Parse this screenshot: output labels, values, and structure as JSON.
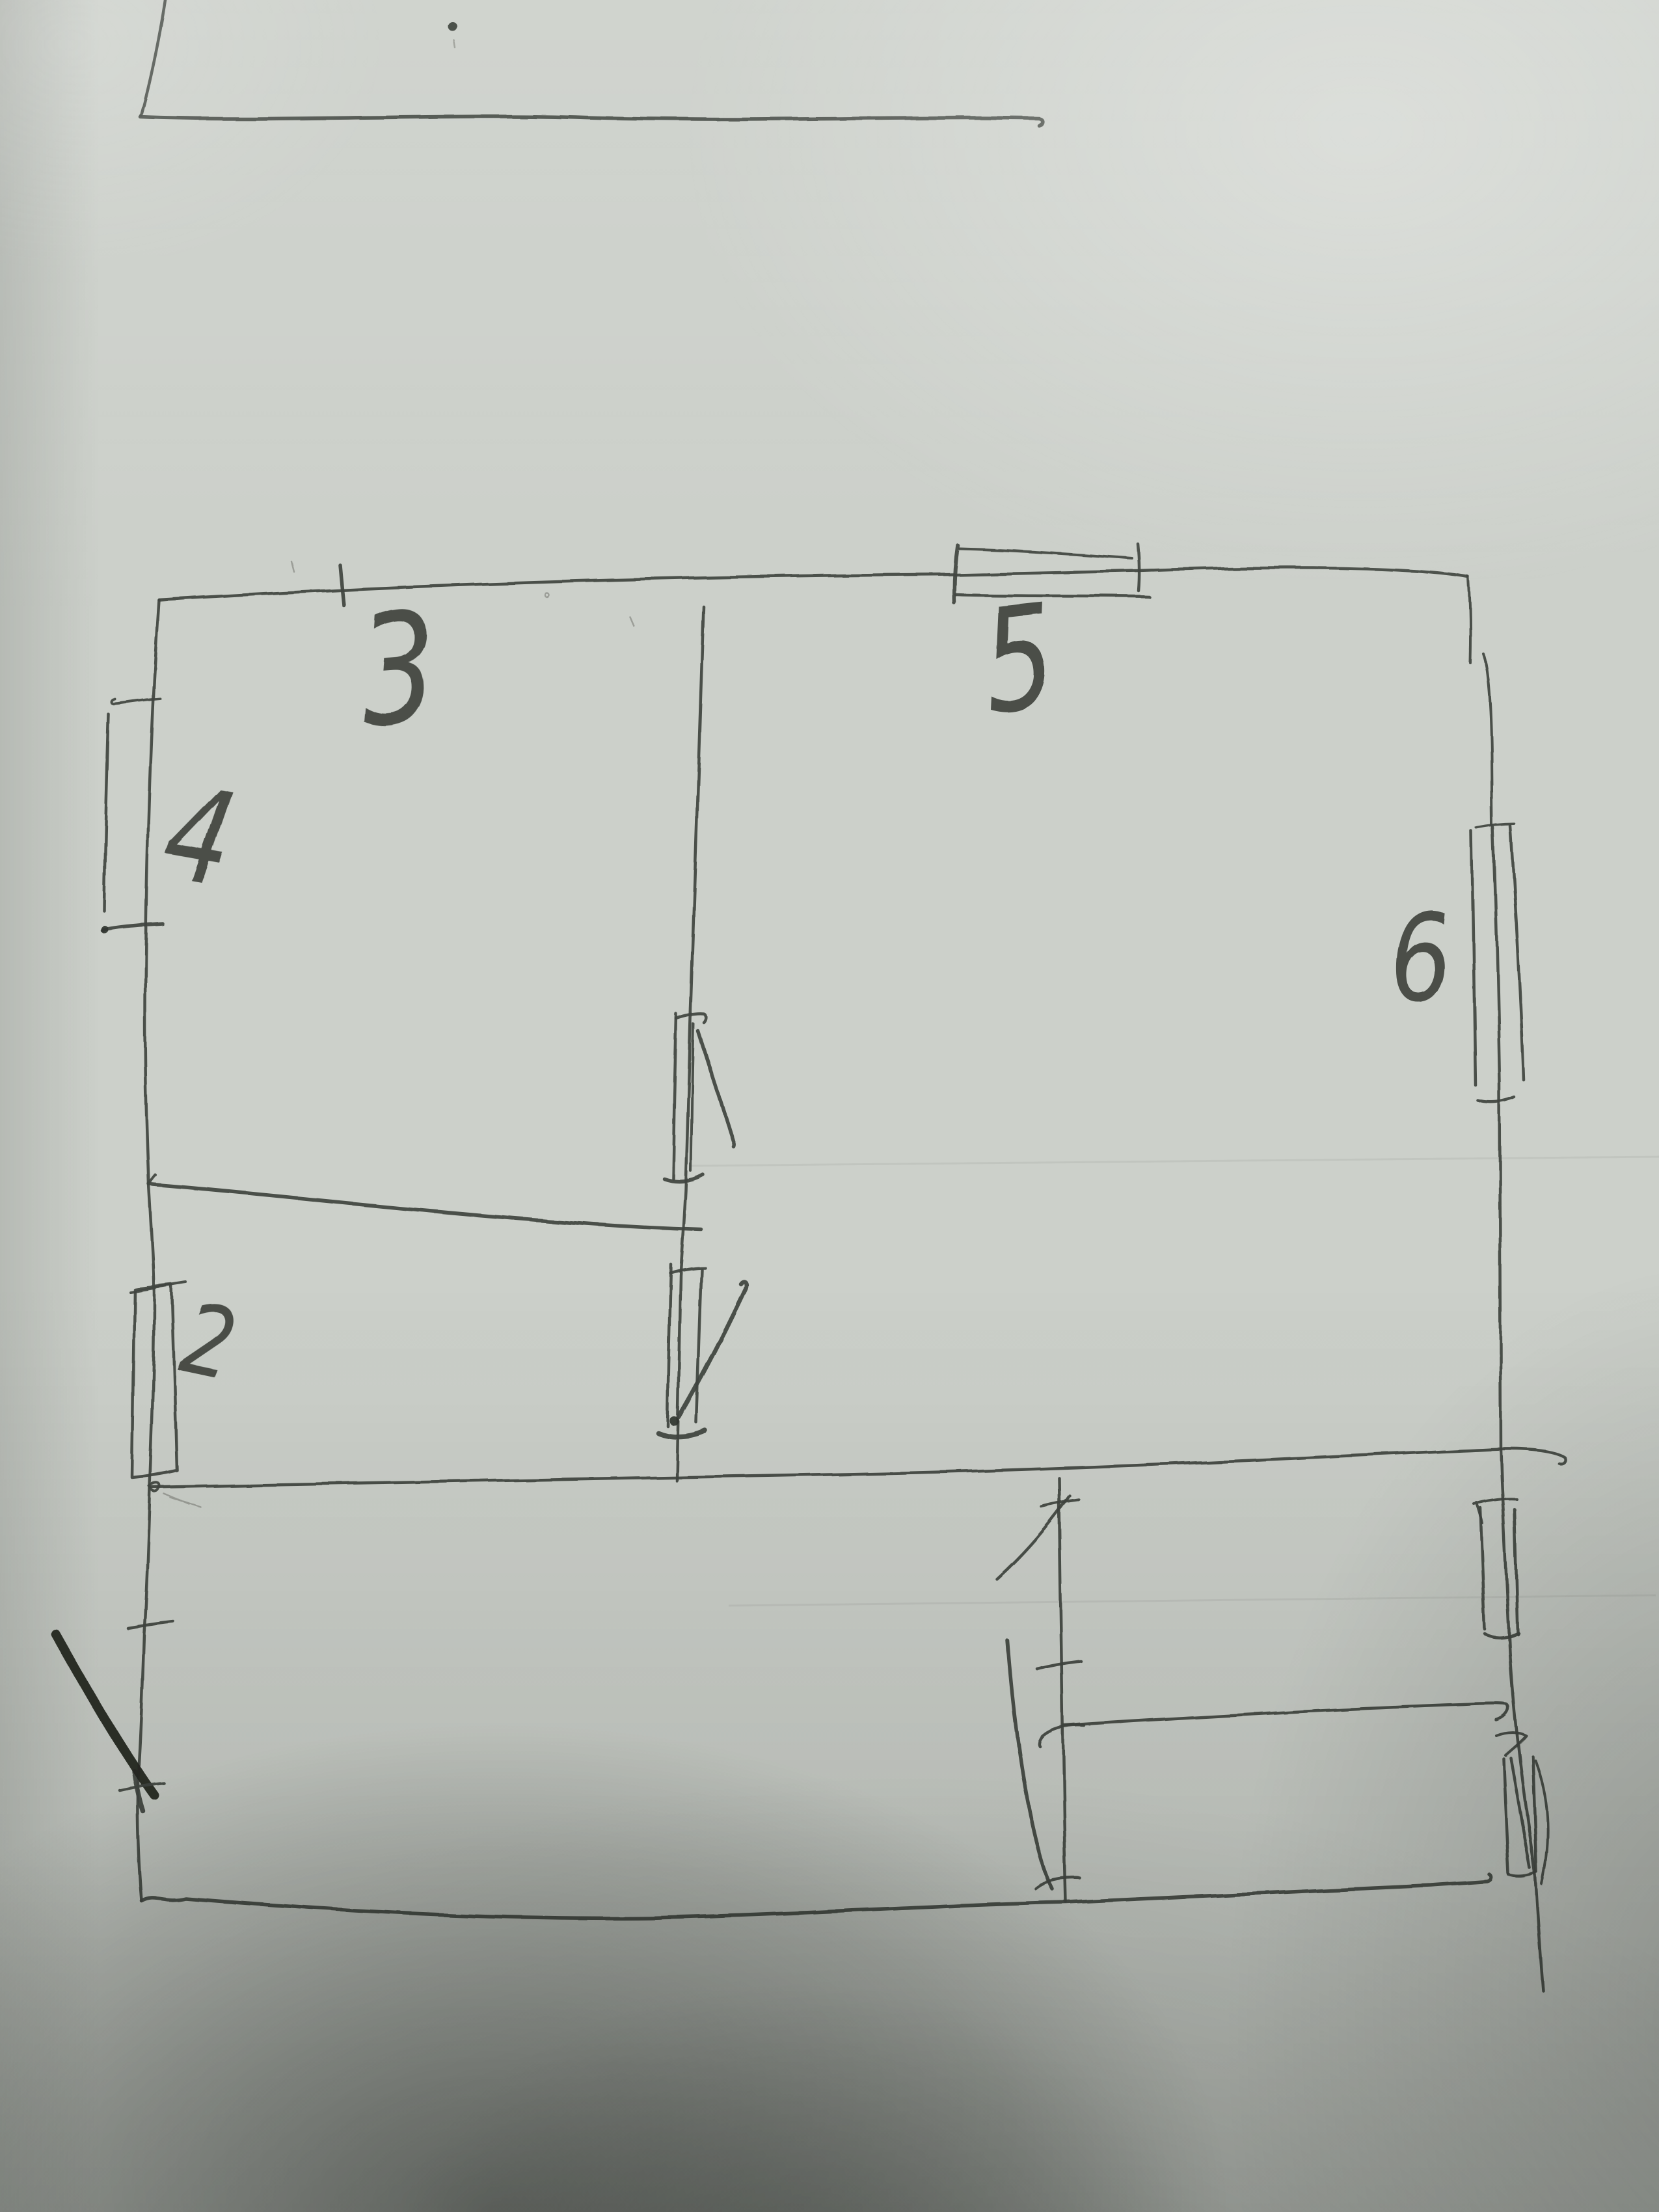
{
  "colors": {
    "paper": "#ccd0ca",
    "paper_bright": "#d6d9d3",
    "ink": "#41463f",
    "ink_bold": "#23261f",
    "shadow": "#878c84"
  },
  "sketch": {
    "kind": "hand-drawn floor plan on paper",
    "labels": [
      {
        "id": "label-3",
        "text": "3",
        "transform": "translate(560,1115) rotate(-4) scale(0.78,1)",
        "size": "235"
      },
      {
        "id": "label-4",
        "text": "4",
        "transform": "translate(245,1345) rotate(10) scale(0.8,1)",
        "size": "200"
      },
      {
        "id": "label-5",
        "text": "5",
        "transform": "translate(1520,1095) rotate(-6) scale(0.78,1)",
        "size": "220"
      },
      {
        "id": "label-6",
        "text": "6",
        "transform": "translate(2140,1540) rotate(-3) scale(0.8,1)",
        "size": "185"
      },
      {
        "id": "label-2",
        "text": "2",
        "transform": "translate(272,2105) rotate(12) scale(0.82,1)",
        "size": "150"
      }
    ]
  }
}
